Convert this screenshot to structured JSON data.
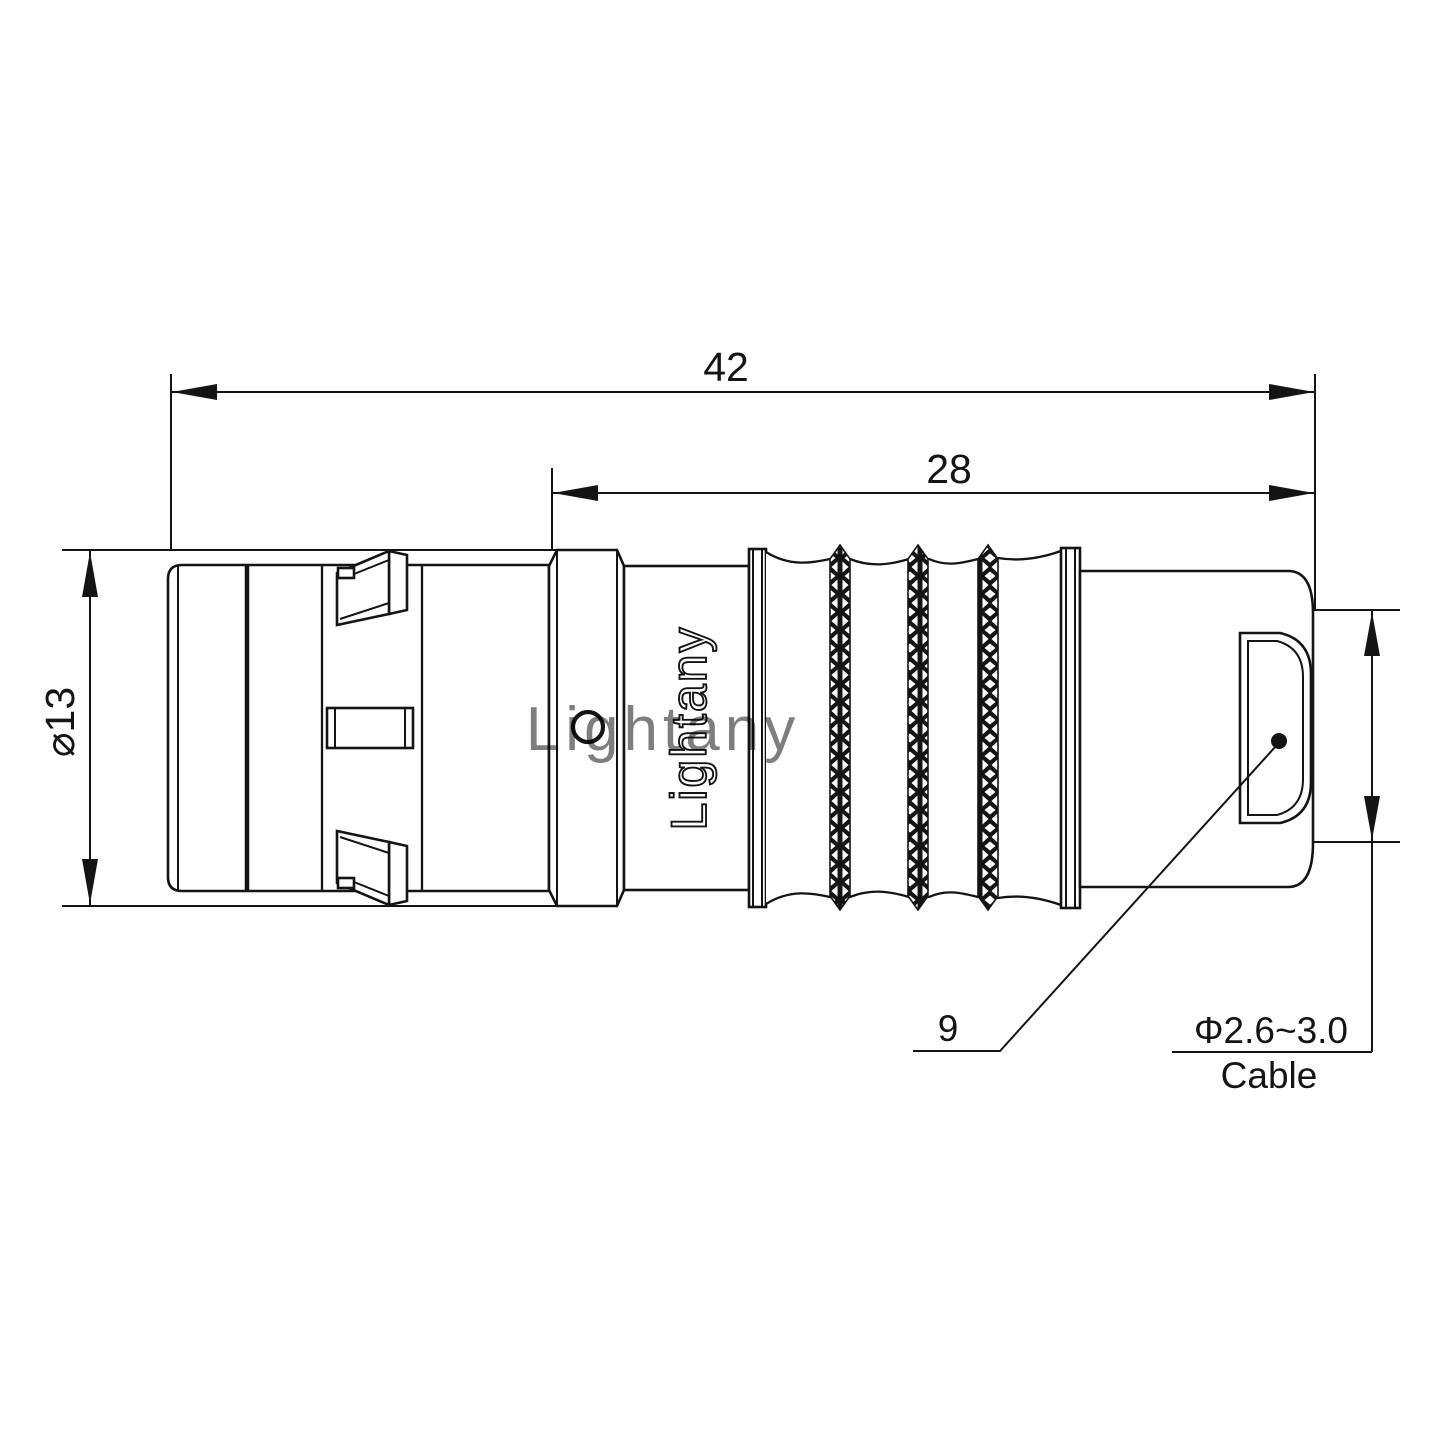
{
  "drawing": {
    "type": "connector-technical-drawing",
    "watermark": {
      "text": "Lightany",
      "color": "#eab6b6"
    },
    "engraving": {
      "text": "Lightany"
    },
    "dimensions": {
      "overall_length": "42",
      "rear_length": "28",
      "body_diameter": "⌀13",
      "nut_width": "9",
      "cable_range": "Φ2.6~3.0",
      "cable_label": "Cable"
    },
    "colors": {
      "line": "#141414",
      "background": "#ffffff",
      "watermark": "#eab6b6"
    }
  }
}
